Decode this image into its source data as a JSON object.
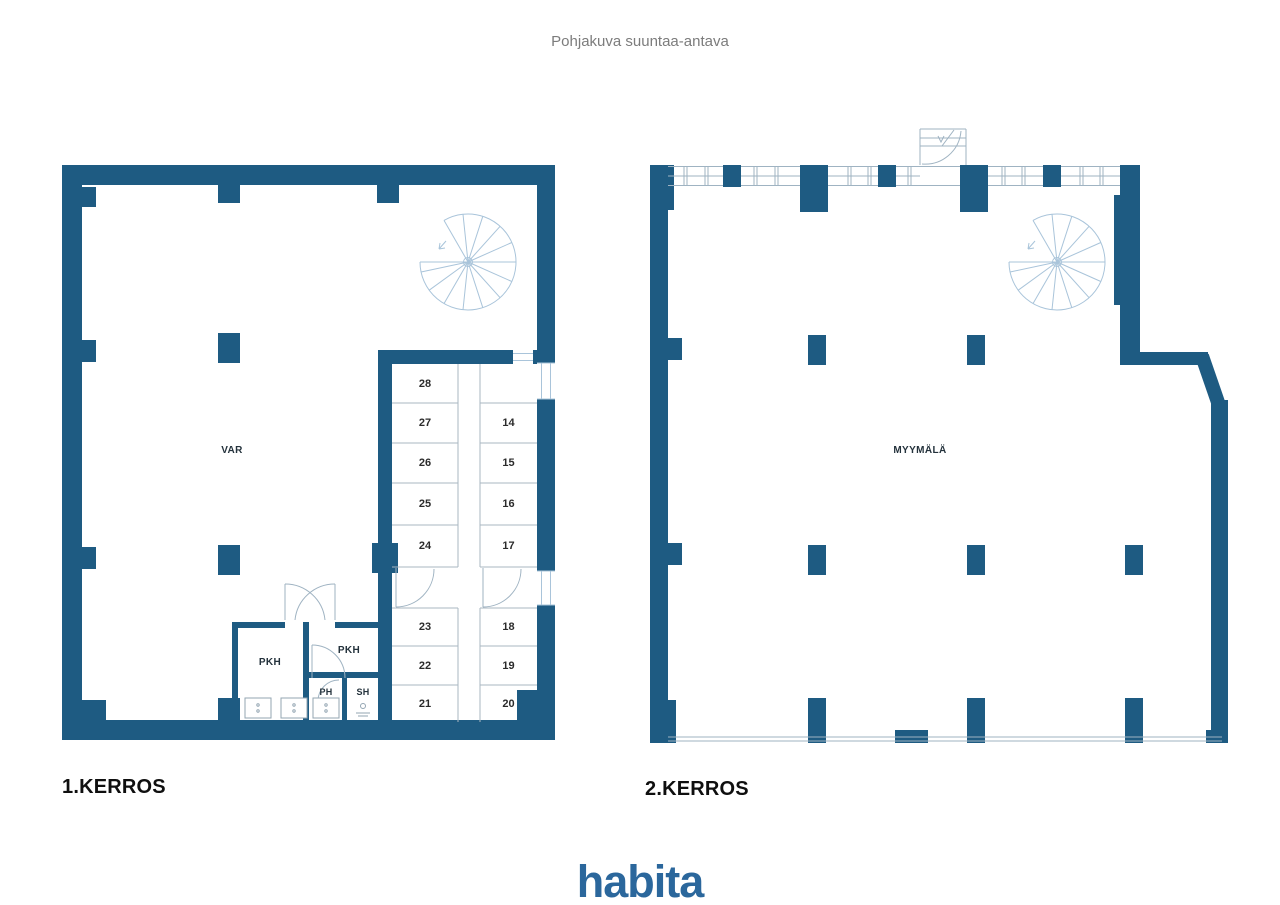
{
  "title": "Pohjakuva suuntaa-antava",
  "logo": "habita",
  "colors": {
    "wall_blue": "#1e5b82",
    "logo_blue": "#2b679c",
    "partition_line": "#aab7c2",
    "window_stair_line": "#a9c4da",
    "title_text": "#7c7c7c",
    "label_text": "#24323c"
  },
  "floor1": {
    "label": "1.KERROS",
    "rooms": {
      "main": "VAR",
      "cloak1": "PKH",
      "cloak2": "PKH",
      "washroom": "PH",
      "shower": "SH"
    },
    "units_left": [
      "28",
      "27",
      "26",
      "25",
      "24",
      "23",
      "22",
      "21"
    ],
    "units_right": [
      "14",
      "15",
      "16",
      "17",
      "18",
      "19",
      "20"
    ]
  },
  "floor2": {
    "label": "2.KERROS",
    "rooms": {
      "main": "MYYMÄLÄ"
    }
  }
}
